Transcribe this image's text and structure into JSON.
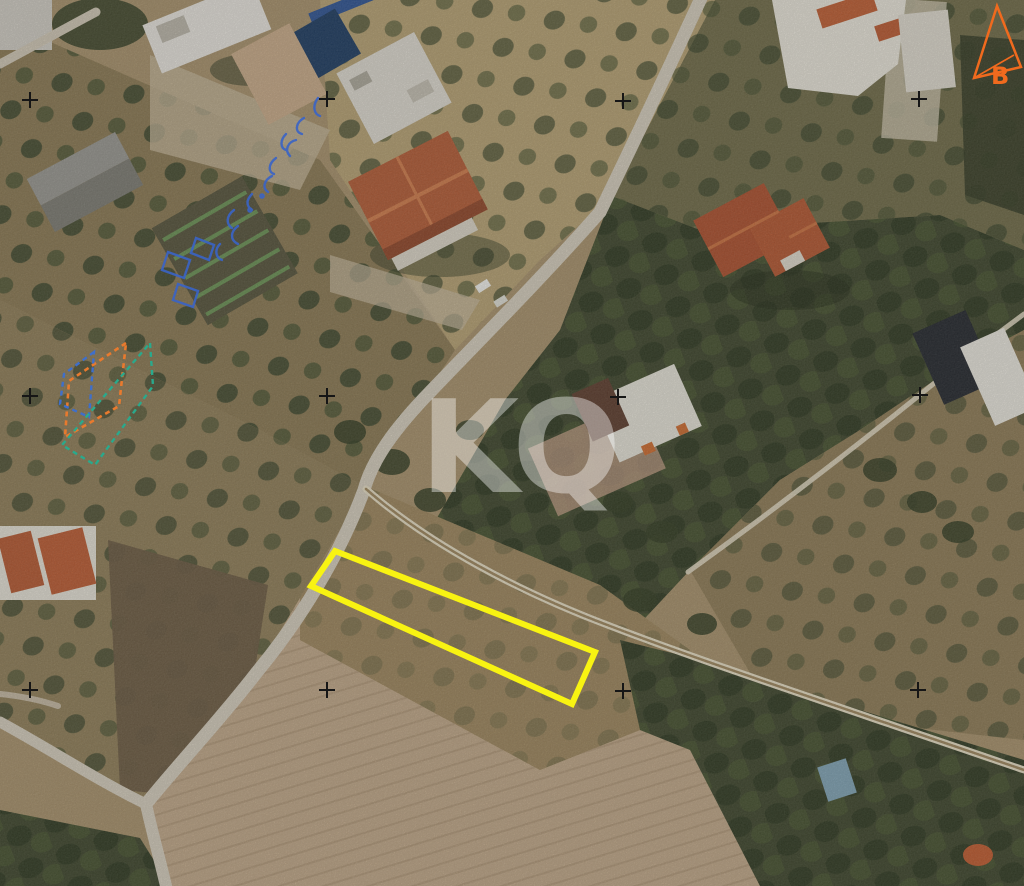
{
  "image": {
    "kind": "aerial-orthophoto with cadastral annotations",
    "width_px": 1024,
    "height_px": 886
  },
  "annotations": {
    "watermark": {
      "text": "KQ",
      "color": "rgba(255,255,255,0.40)"
    },
    "north_arrow": {
      "label": "B",
      "color": "#f06a1e",
      "points": "997,6 974,78 1021,67",
      "fold_points": "974,78 1014,55"
    },
    "parcel_outline": {
      "color": "#f8f312",
      "points": "335,551 595,652 572,704 311,586"
    },
    "overlay_shapes": [
      {
        "name": "orange-dashed-parcel",
        "color": "#e87a2e",
        "points": "126,343 69,381 65,437 119,406"
      },
      {
        "name": "blue-dashed-parcel",
        "color": "#3f6fca",
        "points": "94,352 64,374 60,404 89,417"
      },
      {
        "name": "teal-dashed-parcel",
        "color": "#2aa98c",
        "points": "150,343 153,386 95,465 62,445"
      }
    ],
    "survey_crosses": {
      "color": "#161616",
      "items": [
        {
          "transform": "translate(30,100)"
        },
        {
          "transform": "translate(327,99)"
        },
        {
          "transform": "translate(623,101)"
        },
        {
          "transform": "translate(919,99)"
        },
        {
          "transform": "translate(30,396)"
        },
        {
          "transform": "translate(327,396)"
        },
        {
          "transform": "translate(618,397)"
        },
        {
          "transform": "translate(920,395)"
        },
        {
          "transform": "translate(30,690)"
        },
        {
          "transform": "translate(327,690)"
        },
        {
          "transform": "translate(623,691)"
        },
        {
          "transform": "translate(918,690)"
        }
      ]
    }
  }
}
